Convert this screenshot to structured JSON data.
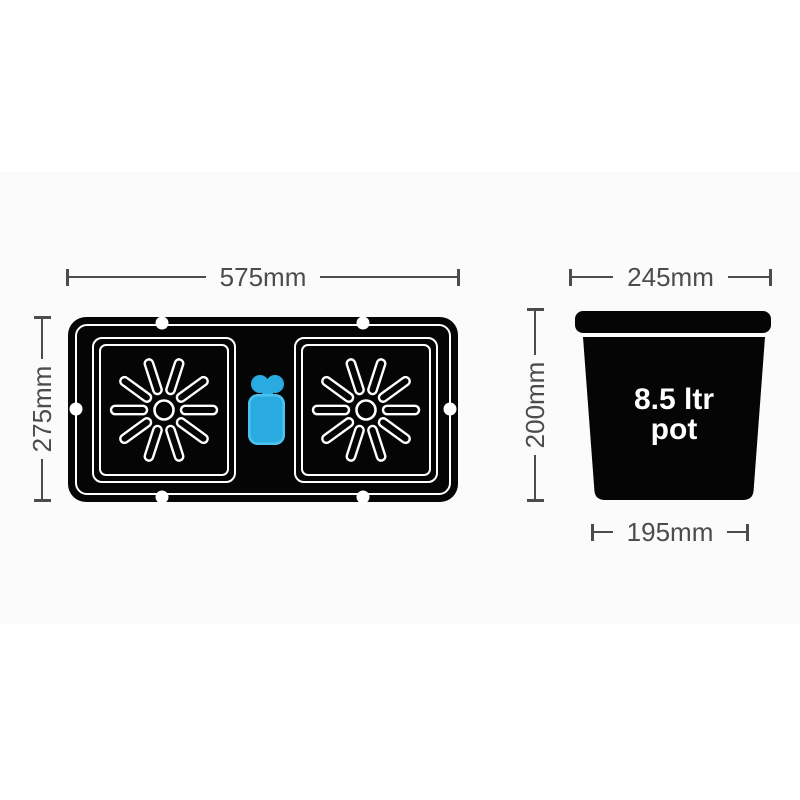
{
  "diagram": {
    "tray": {
      "width_label": "575mm",
      "height_label": "275mm"
    },
    "pot": {
      "top_width_label": "245mm",
      "height_label": "200mm",
      "bottom_width_label": "195mm",
      "volume_line1": "8.5 ltr",
      "volume_line2": "pot"
    },
    "colors": {
      "background": "#ffffff",
      "dimension_gray": "#4c4c4c",
      "product_black": "#050505",
      "outline_white": "#ffffff",
      "valve_blue": "#29abe2"
    }
  }
}
